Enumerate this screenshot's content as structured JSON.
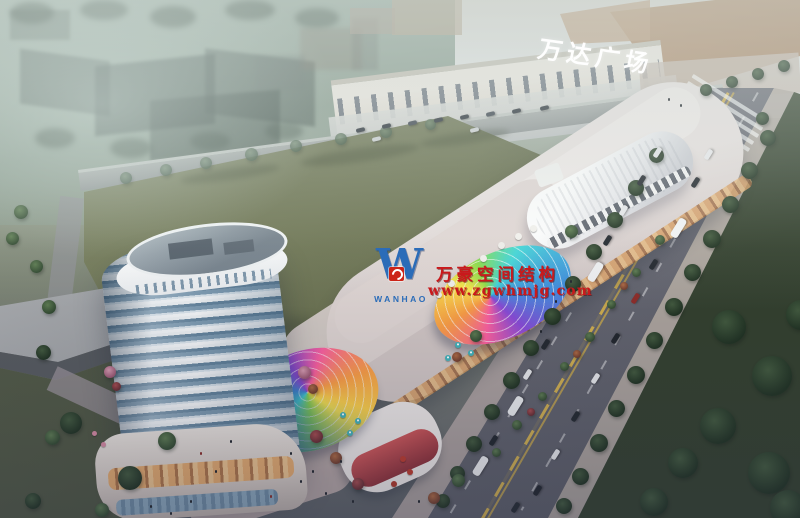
{
  "image": {
    "type": "aerial architectural rendering of a mixed-use commercial complex at dusk",
    "mall_sign": "万达广场",
    "watermark": {
      "company": "万豪空间结构",
      "url": "www.zgwhmjg.com",
      "logo_letter": "W",
      "logo_text": "WANHAO",
      "text_color": "#c9191c",
      "logo_blue": "#2b6cb8",
      "badge_red": "#cc2418"
    },
    "palette": {
      "field_green": "#6e7552",
      "road_grey": "#6b6d79",
      "lawn_dark": "#3d4f38",
      "haze": "#c9d2cf",
      "tower_glass": "#5b7e99",
      "dome_rainbow": [
        "#ff5fa0",
        "#ff9f43",
        "#ffe94a",
        "#8ce04a",
        "#43d9d9",
        "#3f8fe0",
        "#8a4ad9"
      ]
    }
  }
}
